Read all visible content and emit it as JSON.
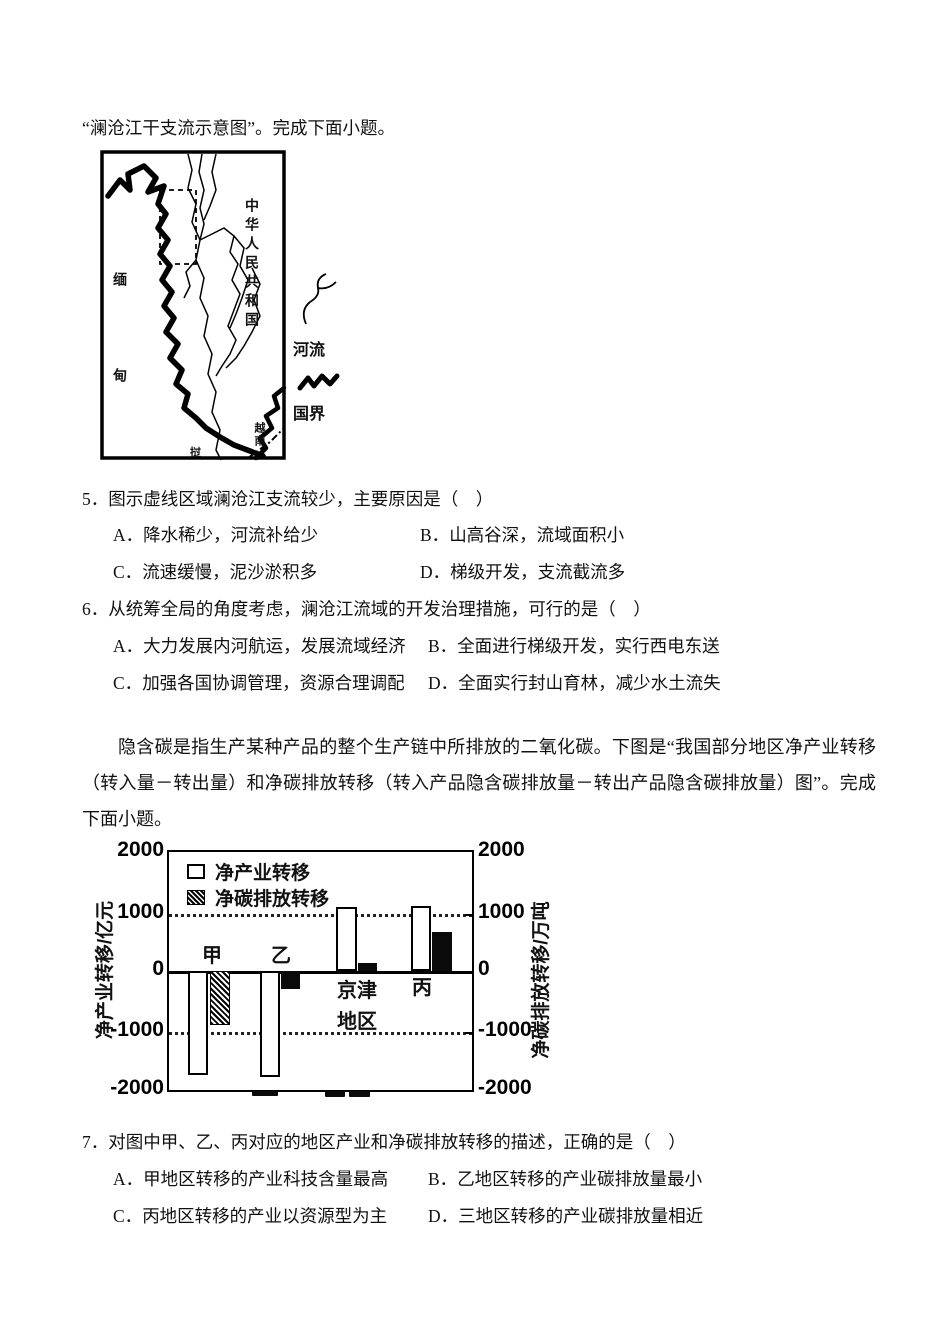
{
  "intro_line": "“澜沧江干支流示意图”。完成下面小题。",
  "map": {
    "china": "中华人民共和国",
    "myanmar": "缅甸",
    "vietnam": "越南",
    "laos": "挝",
    "legend_river": "河流",
    "legend_border": "国界"
  },
  "questions": [
    {
      "number": "5．",
      "stem": "图示虚线区域澜沧江支流较少，主要原因是（　）",
      "options": [
        {
          "key": "A．",
          "text": "降水稀少，河流补给少"
        },
        {
          "key": "B．",
          "text": "山高谷深，流域面积小"
        },
        {
          "key": "C．",
          "text": "流速缓慢，泥沙淤积多"
        },
        {
          "key": "D．",
          "text": "梯级开发，支流截流多"
        }
      ]
    },
    {
      "number": "6．",
      "stem": "从统筹全局的角度考虑，澜沧江流域的开发治理措施，可行的是（　）",
      "options": [
        {
          "key": "A．",
          "text": "大力发展内河航运，发展流域经济"
        },
        {
          "key": "B．",
          "text": "全面进行梯级开发，实行西电东送"
        },
        {
          "key": "C．",
          "text": "加强各国协调管理，资源合理调配"
        },
        {
          "key": "D．",
          "text": "全面实行封山育林，减少水土流失"
        }
      ]
    },
    {
      "number": "7．",
      "stem": "对图中甲、乙、丙对应的地区产业和净碳排放转移的描述，正确的是（　）",
      "options": [
        {
          "key": "A．",
          "text": "甲地区转移的产业科技含量最高"
        },
        {
          "key": "B．",
          "text": "乙地区转移的产业碳排放量最小"
        },
        {
          "key": "C．",
          "text": "丙地区转移的产业以资源型为主"
        },
        {
          "key": "D．",
          "text": "三地区转移的产业碳排放量相近"
        }
      ]
    }
  ],
  "passage": "隐含碳是指生产某种产品的整个生产链中所排放的二氧化碳。下图是“我国部分地区净产业转移（转入量－转出量）和净碳排放转移（转入产品隐含碳排放量－转出产品隐含碳排放量）图”。完成下面小题。",
  "chart_data": {
    "type": "bar",
    "categories": [
      "甲",
      "乙",
      "京津地区",
      "丙"
    ],
    "category_display": {
      "jingjin_line1": "京津",
      "jingjin_line2": "地区"
    },
    "series": [
      {
        "name": "净产业转移",
        "style": "white-outline",
        "values": [
          -1750,
          -1780,
          1070,
          1100
        ]
      },
      {
        "name": "净碳排放转移",
        "style": "dark-fill",
        "values": [
          -900,
          -300,
          130,
          650
        ]
      }
    ],
    "left_axis": {
      "label": "净产业转移/亿元",
      "ticks": [
        2000,
        1000,
        0,
        -1000,
        -2000
      ]
    },
    "right_axis": {
      "label": "净碳排放转移/万吨",
      "ticks": [
        2000,
        1000,
        0,
        -1000,
        -2000
      ]
    },
    "ylim": [
      -2000,
      2000
    ],
    "dotted_gridlines": [
      1000,
      -1000
    ],
    "legend_position": "top-left-inside"
  }
}
